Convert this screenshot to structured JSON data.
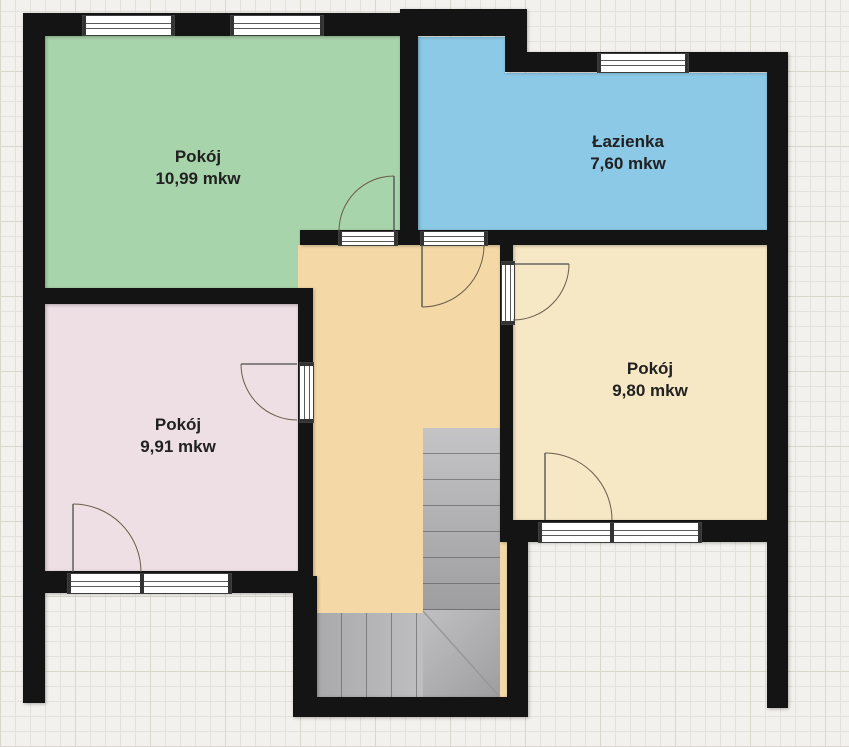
{
  "plan": {
    "background_color": "#f2f1ed",
    "grid_line_color": "#e3e1d9",
    "grid_major_line_color": "#d9d6cb",
    "wall_color": "#141414",
    "hallway_color": "#f4d9a6",
    "stairs_color": "#b4b4b6",
    "rooms": [
      {
        "name": "Pokój",
        "area": "10,99 mkw",
        "color": "#a8d4ab"
      },
      {
        "name": "Łazienka",
        "area": "7,60 mkw",
        "color": "#8bc9e7"
      },
      {
        "name": "Pokój",
        "area": "9,91 mkw",
        "color": "#eddfe4"
      },
      {
        "name": "Pokój",
        "area": "9,80 mkw",
        "color": "#f6e8c5"
      }
    ]
  }
}
